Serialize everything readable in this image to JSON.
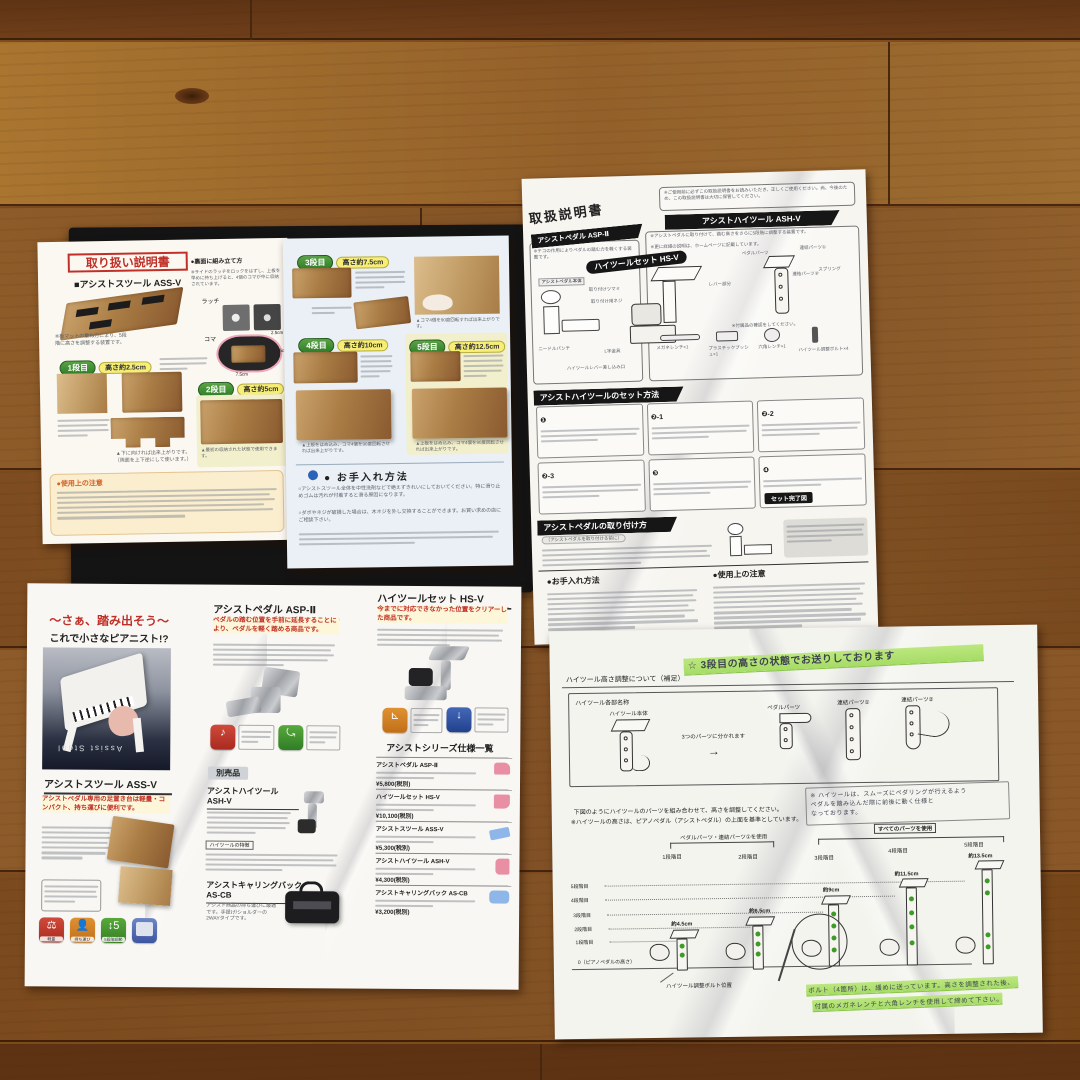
{
  "colors": {
    "floor_light": "#a8742f",
    "floor_dark": "#6e3c19",
    "box_black": "#141414",
    "accent_red": "#c03028",
    "badge_green": "#3f8f3f",
    "highlight_yellow": "#f6ee77",
    "banner_black": "#161616",
    "highlighter_green": "#b4e47e",
    "bolt_green": "#3e9b28",
    "page_blue_tint": "#eaf0f5"
  },
  "manual_stool": {
    "title": "取り扱い説明書",
    "title_note": "●裏面に組み立て方",
    "product": "■アシストスツール ASS-V",
    "photo_note": "※サイドのラッチをロックをはずし、上板を早めに持ち上げると、4個のコマが中に収納されています。",
    "intro": "※板マットの重ね方により、5段階に高さを調整する装置です。",
    "label_latch": "ラッチ",
    "label_koma": "コマ",
    "dim_25": "2.5cm",
    "dim_5": "5cm",
    "dim_75": "7.5cm",
    "steps": [
      {
        "badge": "1段目",
        "height": "高さ約2.5cm"
      },
      {
        "badge": "2段目",
        "height": "高さ約5cm"
      },
      {
        "badge": "3段目",
        "height": "高さ約7.5cm"
      },
      {
        "badge": "4段目",
        "height": "高さ約10cm"
      },
      {
        "badge": "5段目",
        "height": "高さ約12.5cm"
      }
    ],
    "caption_step2": "▲最初の収納された状態で使用できます。",
    "caption_flip1": "▲下に向ければ出来上がりです。",
    "caption_flip2": "（両面を上下逆にして使います。）",
    "caption_step3": "▲コマ4個を90度回転すれば出来上がりです。",
    "caption_step45": "▲上板をはめ込み、コマ4個を90度回転させれば出来上がりです。",
    "caution_title": "●使用上の注意",
    "care_title": "● お手入れ方法",
    "care_text1": "○アシストスツール全体を中性洗剤などで絶えずきれいにしておいてください。特に滑り止めゴムは汚れが付着すると滑る原因になります。",
    "care_text2": "○ダボやネジが破損した場合は、木ネジを外し交換することができます。お買い求めの店にご相談下さい。"
  },
  "manual_pedal": {
    "title": "取扱説明書",
    "notice": "※ご使用前に必ずこの取扱説明書をお読みいただき、正しくご使用ください。尚、今後のため、この取扱説明書は大切に保管してください。",
    "badge_pedal": "アシストペダル ASP-Ⅱ",
    "pedal_note": "※テコの作用によりペダルの踏む力を軽くする装置です。",
    "badge_hiset": "ハイツールセット HS-V",
    "bar_hitool": "アシストハイツール ASH-V",
    "hitool_note1": "※アシストペダルに取り付けて、踏む高さをさらに5段階に調整する装置です。",
    "hitool_note2": "※更に詳細の説明は、ホームページに記載しています。",
    "lbl_body": "アシストペダル本体",
    "lbl_tsumami": "取り付けツマミ",
    "lbl_neji": "取り付け用ネジ",
    "lbl_needle": "ニードルパンチ",
    "lbl_lkanagu": "L字金具",
    "lbl_lever_slot": "ハイツールレバー差し込み口",
    "lbl_pedal_parts": "ペダルパーツ",
    "lbl_renketsu1": "連結パーツ①",
    "lbl_renketsu2": "連結パーツ②",
    "lbl_lever": "レバー部分",
    "lbl_spring": "スプリング",
    "parts_note": "※付属品の確認をしてください。",
    "part_items": [
      "メガネレンチ×1",
      "六角レンチ×1",
      "プラスチックブッシュ×1",
      "ハイツール調整ボルト×4"
    ],
    "section_set": "アシストハイツールのセット方法",
    "step_nums": [
      "❶",
      "❷-1",
      "❷-2",
      "❷-3",
      "❸",
      "❹"
    ],
    "set_done": "セット完了図",
    "section_attach": "アシストペダルの取り付け方",
    "attach_sub": "（アシストペダルを取り付ける前に）",
    "care_title": "●お手入れ方法",
    "caution_title": "●使用上の注意"
  },
  "brochure": {
    "headline1": "〜さぁ、踏み出そう〜",
    "headline2": "これで小さなピアニスト!?",
    "piano_text": "Assist Stool",
    "stool_title": "アシストスツール ASS-V",
    "stool_lead": "アシストペダル専用の足置き台は軽量・コンパクト、持ち運びに便利です。",
    "badge_labels": [
      "軽量",
      "持ち運び",
      "5段階調節",
      ""
    ],
    "pedal_title": "アシストペダル ASP-Ⅱ",
    "pedal_lead": "ペダルの踏む位置を手前に延長することにより、ペダルを軽く踏める商品です。",
    "separate_title": "別売品",
    "hitool_title": "アシストハイツール ASH-V",
    "feature_title": "ハイツールの特徴",
    "bag_title": "アシストキャリングバック AS-CB",
    "bag_body": "アシスト商品の持ち運びに最適です。手提げ/ショルダーの2WAYタイプです。",
    "hiset_title": "ハイツールセット HS-V",
    "hiset_lead": "今までに対応できなかった位置をクリアーした商品です。",
    "spec_title": "アシストシリーズ仕様一覧",
    "specs": [
      {
        "name": "アシストペダル ASP-Ⅱ",
        "price": "¥5,800(税別)"
      },
      {
        "name": "ハイツールセット HS-V",
        "price": "¥10,100(税別)"
      },
      {
        "name": "アシストスツール ASS-V",
        "price": "¥5,300(税別)"
      },
      {
        "name": "アシストハイツール ASH-V",
        "price": "¥4,300(税別)"
      },
      {
        "name": "アシストキャリングバック AS-CB",
        "price": "¥3,200(税別)"
      }
    ]
  },
  "note_sheet": {
    "heading": "ハイツール高さ調整について（補足）",
    "hw_top": "☆ 3段目の高さの状態でお送りしております",
    "parts_title": "ハイツール各部名称",
    "part_main": "ハイツール本体",
    "split_note": "3つのパーツに分かれます",
    "arrow": "→",
    "part1": "ペダルパーツ",
    "part2": "連結パーツ①",
    "part3": "連結パーツ②",
    "instr1": "下図のようにハイツールのパーツを組み合わせて、高さを調整してください。",
    "instr2": "※ハイツールの高さは、ピアノペダル（アシストペダル）の上面を基準としています。",
    "hw_side1": "※ ハイツールは、スムーズにペダリングが行えるよう",
    "hw_side2": "ペダルを踏み込んだ際に前後に動く仕様と",
    "hw_side3": "なっております。",
    "group1": "ペダルパーツ・連結パーツ①を使用",
    "group2": "すべてのパーツを使用",
    "stage_labels": [
      "1段階目",
      "2段階目",
      "3段階目",
      "4段階目",
      "5段階目"
    ],
    "axis_labels": [
      "5段階目",
      "4段階目",
      "3段階目",
      "2段階目",
      "1段階目",
      "0（ピアノペダルの高さ）"
    ],
    "heights": [
      "約4.5cm",
      "約6.5cm",
      "約9cm",
      "約11.5cm",
      "約13.5cm"
    ],
    "bolt_label": "ハイツール調整ボルト位置",
    "hw_bottom1": "ボルト（4箇所）は、緩めに送っています。高さを調整された後、",
    "hw_bottom2": "付属のメガネレンチと六角レンチを使用して締めて下さい。"
  }
}
